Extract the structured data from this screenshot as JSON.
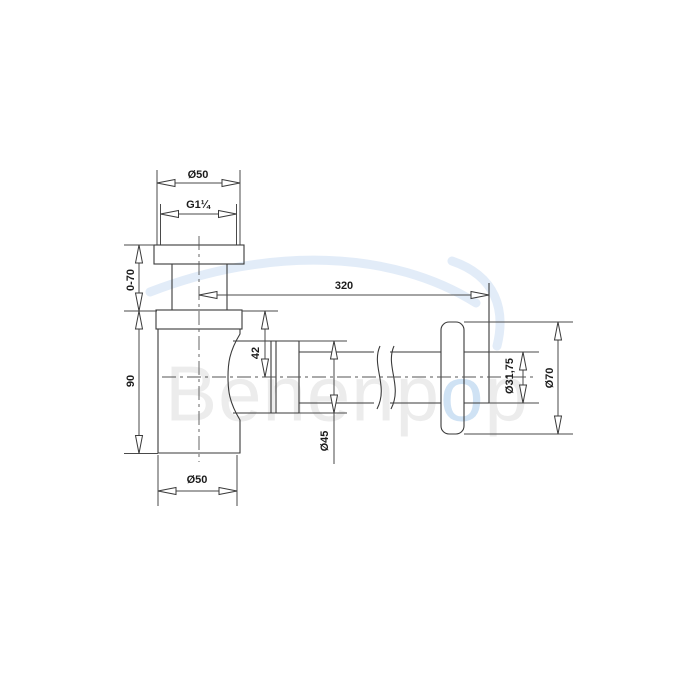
{
  "drawing": {
    "line_color": "#3a3a3a",
    "centerline_color": "#555555",
    "dimensions": {
      "top_diameter": "Ø50",
      "thread_size": "G1¼",
      "adjustable_height": "0-70",
      "body_height": "90",
      "horizontal_length": "320",
      "outlet_centre_offset": "42",
      "outlet_nut_diameter": "Ø45",
      "wall_pipe_diameter": "Ø31,75",
      "wall_flange_diameter": "Ø70",
      "body_diameter": "Ø50"
    }
  },
  "watermark": {
    "gray_left": "Benenp",
    "accent_letter": "o",
    "gray_right": "p",
    "gray_color": "#ececec",
    "accent_color": "#cfe2f4"
  }
}
